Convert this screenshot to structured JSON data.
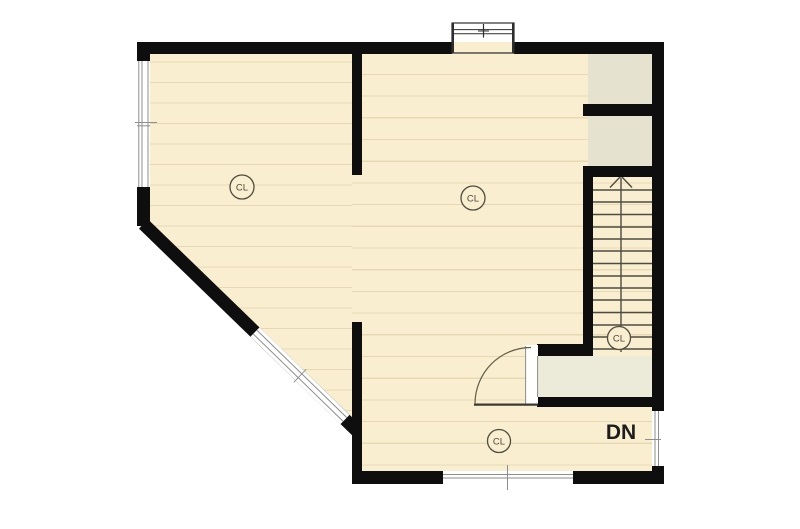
{
  "labels": {
    "closet_left": {
      "text": "CL"
    },
    "closet_right": {
      "text": "CL"
    },
    "closet_stair": {
      "text": "CL"
    },
    "closet_hall": {
      "text": "CL"
    },
    "stair_direction": {
      "text": "DN"
    }
  },
  "colors": {
    "page_bg": "#ffffff",
    "floor": "#f9efd0",
    "floor_line": "#e7d9b4",
    "closet_cell": "#e5e3cf",
    "landing": "#ecebd9",
    "wall": "#0e0e0e",
    "stair_line": "#4e4c42",
    "label_ink": "#4f4d3e",
    "dn_ink": "#1d1d1d",
    "window_line": "#8e8e8e",
    "door_arc": "#5f5c49",
    "chimney_line": "#2e2e2e"
  }
}
